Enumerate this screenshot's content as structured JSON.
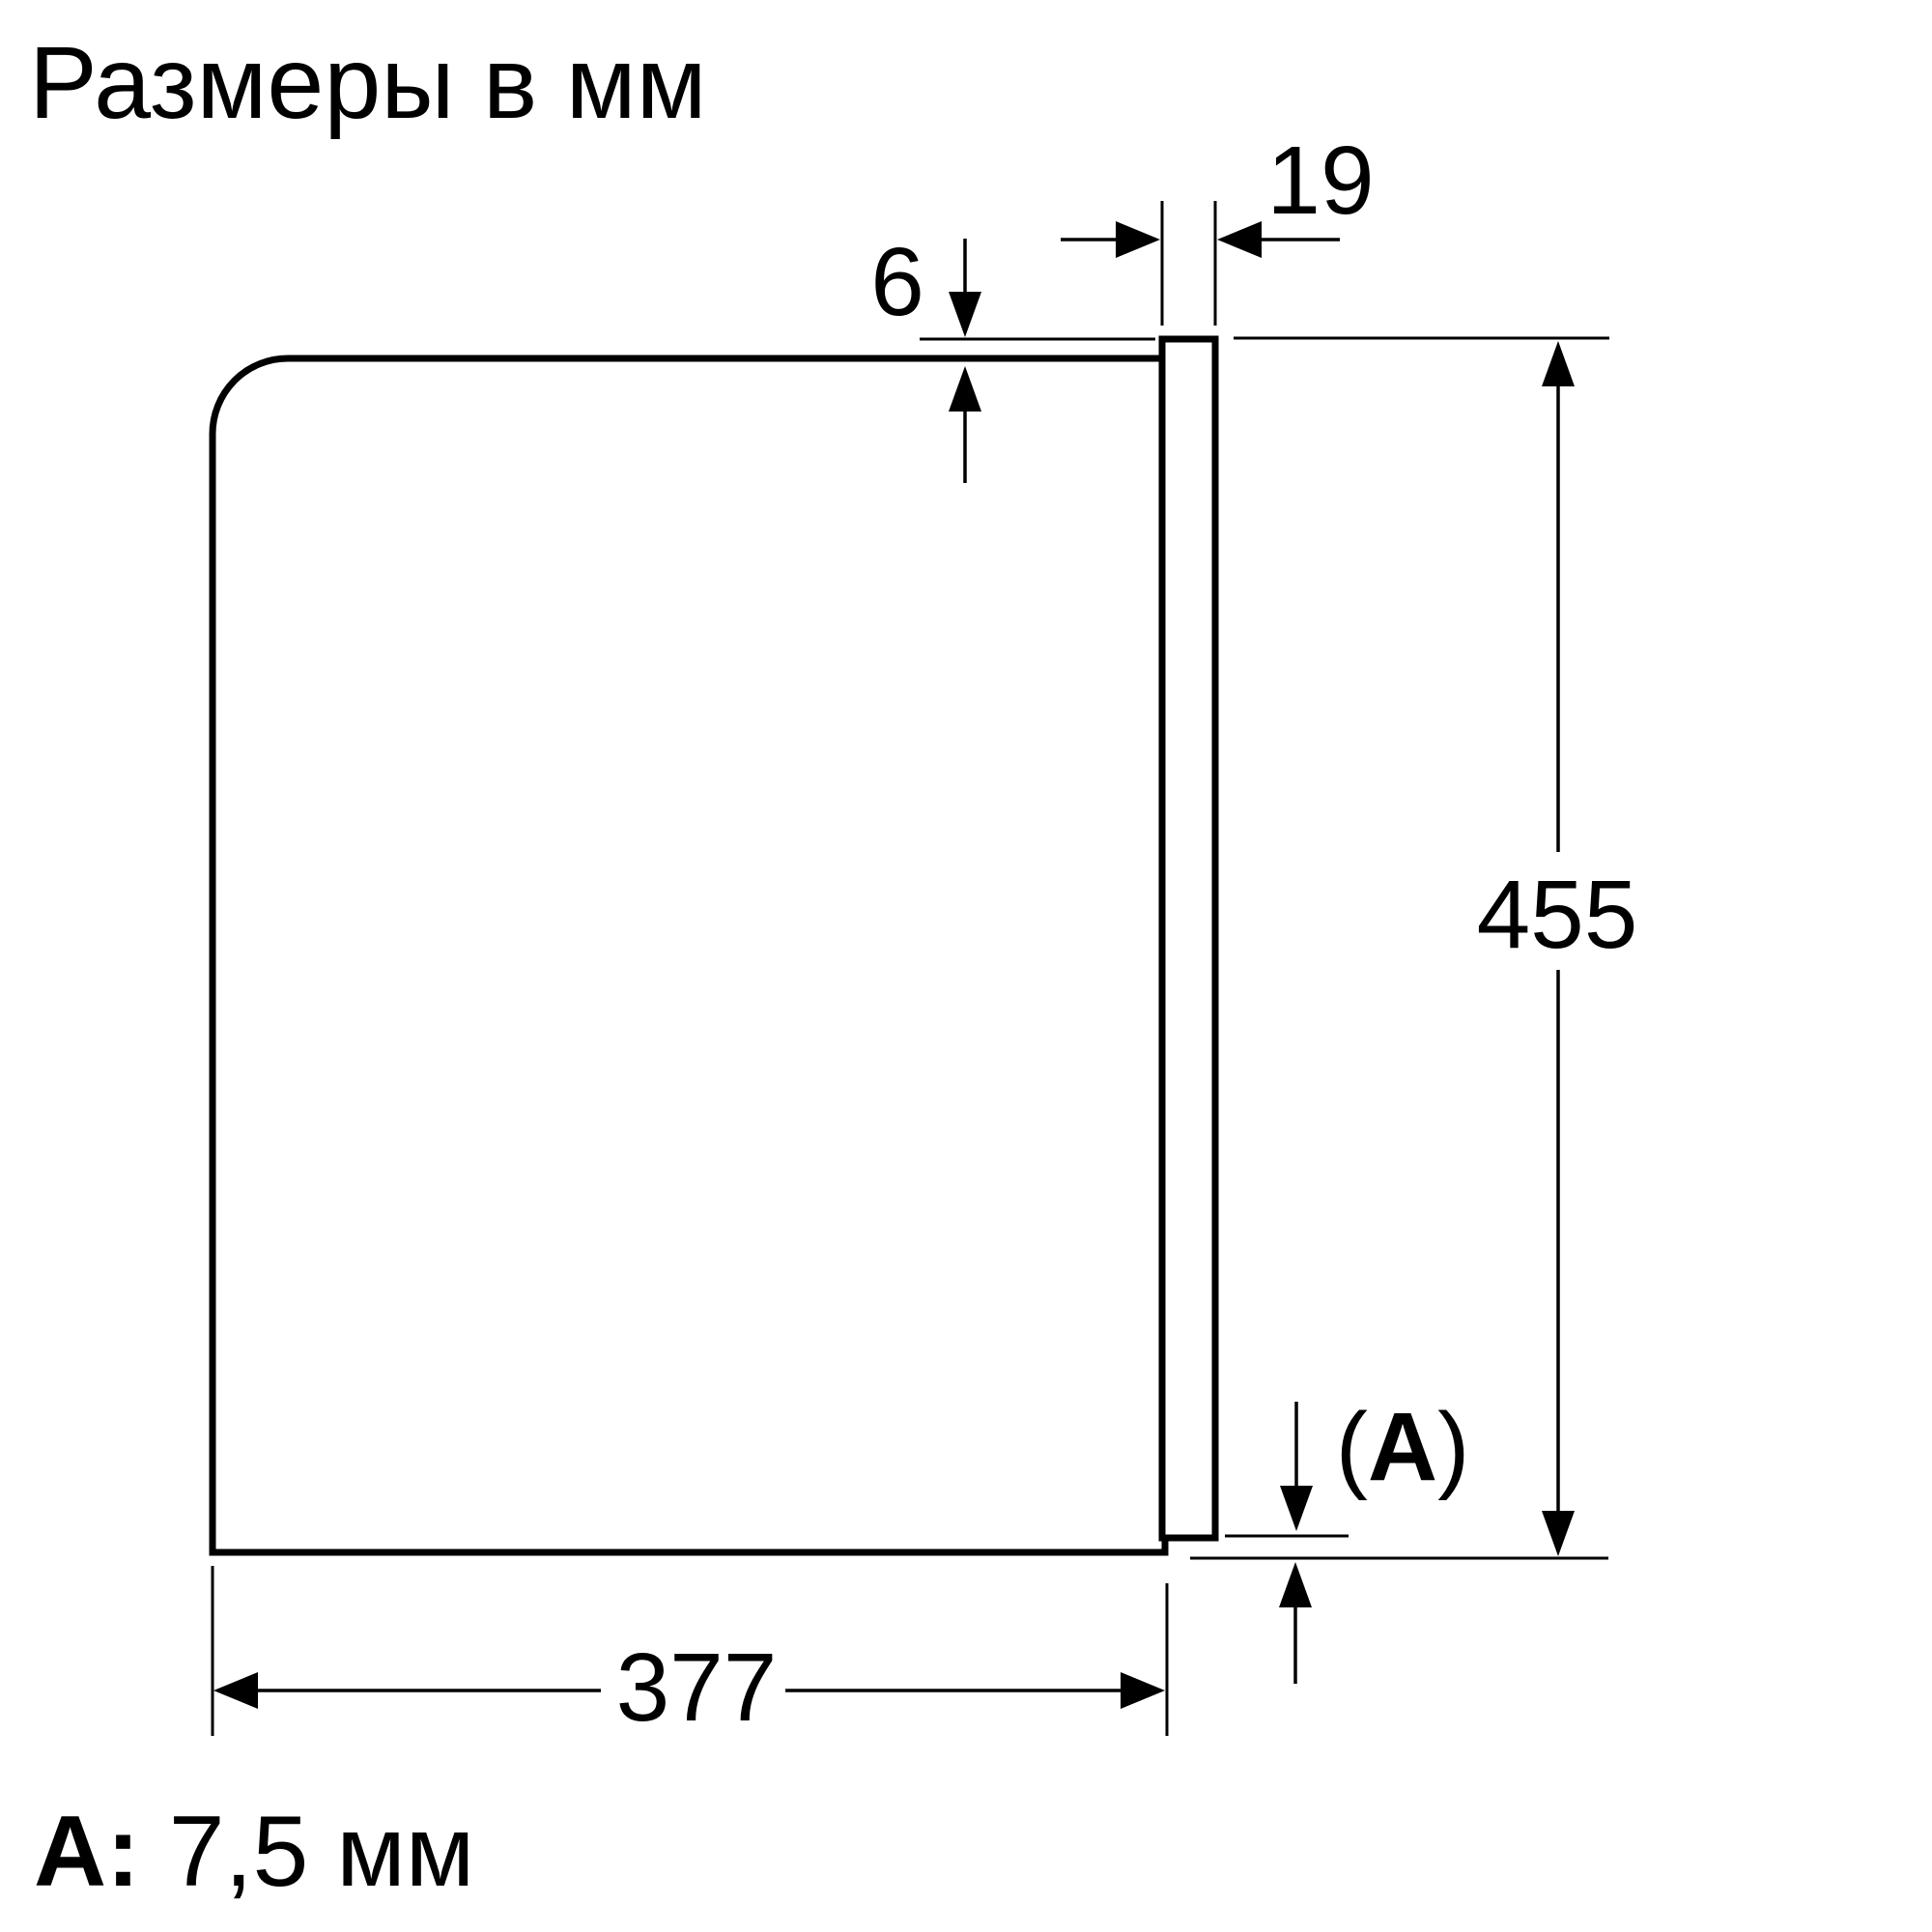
{
  "title": "Размеры в мм",
  "diagram": {
    "type": "appliance-side-view-dimension-drawing",
    "dimensions": {
      "door_top_overhang_mm": "6",
      "door_thickness_mm": "19",
      "height_mm": "455",
      "depth_mm": "377",
      "a_open": "(",
      "a_letter": "A",
      "a_close": ")"
    }
  },
  "note": {
    "label": "A:",
    "value": "7,5 мм"
  },
  "colors": {
    "line": "#000000",
    "background": "#ffffff"
  }
}
